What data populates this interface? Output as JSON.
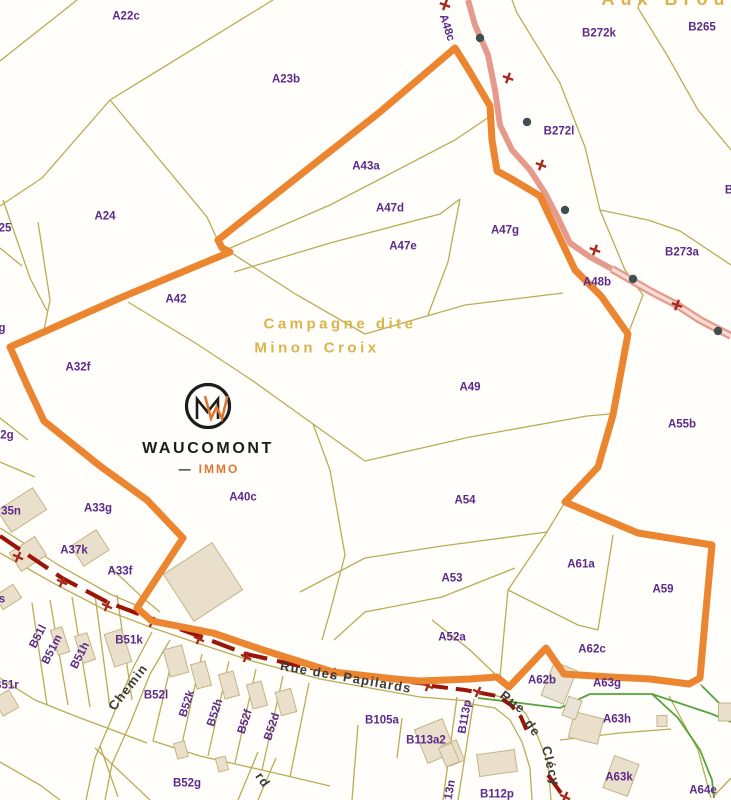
{
  "map": {
    "area_labels": [
      {
        "text": "Aux Brou",
        "x": 666,
        "y": -1,
        "size": 18,
        "ls": 6
      },
      {
        "text": "Campagne dite",
        "x": 340,
        "y": 324
      },
      {
        "text": "Minon Croix",
        "x": 317,
        "y": 348
      }
    ],
    "parcel_labels": [
      {
        "text": "A22c",
        "x": 126,
        "y": 17
      },
      {
        "text": "A23b",
        "x": 286,
        "y": 80
      },
      {
        "text": "A24",
        "x": 105,
        "y": 217
      },
      {
        "text": "25",
        "x": 5,
        "y": 229
      },
      {
        "text": "A43a",
        "x": 366,
        "y": 167
      },
      {
        "text": "A47d",
        "x": 390,
        "y": 209
      },
      {
        "text": "A47e",
        "x": 403,
        "y": 247
      },
      {
        "text": "A47g",
        "x": 505,
        "y": 231
      },
      {
        "text": "A48c",
        "x": 446,
        "y": 28,
        "rot": 72
      },
      {
        "text": "A48b",
        "x": 597,
        "y": 283
      },
      {
        "text": "B272k",
        "x": 599,
        "y": 34
      },
      {
        "text": "B265",
        "x": 702,
        "y": 28
      },
      {
        "text": "B272l",
        "x": 559,
        "y": 132
      },
      {
        "text": "B273a",
        "x": 682,
        "y": 253
      },
      {
        "text": "B",
        "x": 729,
        "y": 191
      },
      {
        "text": "A42",
        "x": 176,
        "y": 300
      },
      {
        "text": "g",
        "x": 2,
        "y": 329
      },
      {
        "text": "A32f",
        "x": 78,
        "y": 368
      },
      {
        "text": "2g",
        "x": 7,
        "y": 436
      },
      {
        "text": "A49",
        "x": 470,
        "y": 388
      },
      {
        "text": "A55b",
        "x": 682,
        "y": 425
      },
      {
        "text": "35n",
        "x": 11,
        "y": 512
      },
      {
        "text": "A33g",
        "x": 98,
        "y": 509
      },
      {
        "text": "A37k",
        "x": 74,
        "y": 551
      },
      {
        "text": "A33f",
        "x": 120,
        "y": 572
      },
      {
        "text": "A40c",
        "x": 243,
        "y": 498
      },
      {
        "text": "A54",
        "x": 465,
        "y": 501
      },
      {
        "text": "A53",
        "x": 452,
        "y": 579
      },
      {
        "text": "A52a",
        "x": 452,
        "y": 638
      },
      {
        "text": "A61a",
        "x": 581,
        "y": 565
      },
      {
        "text": "A59",
        "x": 663,
        "y": 590
      },
      {
        "text": "A62c",
        "x": 592,
        "y": 650
      },
      {
        "text": "A62b",
        "x": 542,
        "y": 681
      },
      {
        "text": "A63g",
        "x": 607,
        "y": 684
      },
      {
        "text": "A63h",
        "x": 617,
        "y": 720
      },
      {
        "text": "A63k",
        "x": 619,
        "y": 778
      },
      {
        "text": "A64e",
        "x": 703,
        "y": 791
      },
      {
        "text": "B51l",
        "x": 39,
        "y": 637,
        "rot": -63
      },
      {
        "text": "B51m",
        "x": 53,
        "y": 650,
        "rot": -63
      },
      {
        "text": "B51h",
        "x": 81,
        "y": 656,
        "rot": -63
      },
      {
        "text": "B51k",
        "x": 129,
        "y": 641
      },
      {
        "text": "B51r",
        "x": 6,
        "y": 686
      },
      {
        "text": "s",
        "x": 2,
        "y": 600
      },
      {
        "text": "B52l",
        "x": 156,
        "y": 696
      },
      {
        "text": "B52k",
        "x": 188,
        "y": 704,
        "rot": -72
      },
      {
        "text": "B52h",
        "x": 216,
        "y": 713,
        "rot": -72
      },
      {
        "text": "B52f",
        "x": 246,
        "y": 722,
        "rot": -72
      },
      {
        "text": "B52d",
        "x": 273,
        "y": 727,
        "rot": -72
      },
      {
        "text": "B52g",
        "x": 187,
        "y": 784
      },
      {
        "text": "B105a",
        "x": 382,
        "y": 721
      },
      {
        "text": "B113a2",
        "x": 426,
        "y": 741
      },
      {
        "text": "B113p",
        "x": 466,
        "y": 717,
        "rot": -80
      },
      {
        "text": "13n",
        "x": 451,
        "y": 790,
        "rot": -80
      },
      {
        "text": "B112p",
        "x": 497,
        "y": 795
      }
    ],
    "street_labels": [
      {
        "text": "Chemin",
        "x": 128,
        "y": 687,
        "rot": -52
      },
      {
        "text": "Rue des Papilards",
        "x": 346,
        "y": 677,
        "rot": 10
      },
      {
        "text": "Rue",
        "x": 513,
        "y": 702,
        "rot": 38
      },
      {
        "text": "de",
        "x": 533,
        "y": 728,
        "rot": 55
      },
      {
        "text": "Clécy",
        "x": 551,
        "y": 766,
        "rot": 76
      },
      {
        "text": "rd",
        "x": 263,
        "y": 780,
        "rot": 55
      }
    ],
    "logo": {
      "name": "WAUCOMONT",
      "dash": "—",
      "sub": "IMMO"
    },
    "colors": {
      "boundary": "#EC8530",
      "road_secondary": "#E69A8B",
      "road_main": "#9B1408",
      "parcel_line": "#B7A84E",
      "parcel_label": "#5B2A8A",
      "area_label": "#D9B44A",
      "street_label": "#3A3A3A",
      "vegetation_line": "#55A43B",
      "building_fill": "#EADFCB",
      "logo_orange": "#DD7733",
      "logo_black": "#1C1C1A"
    }
  }
}
